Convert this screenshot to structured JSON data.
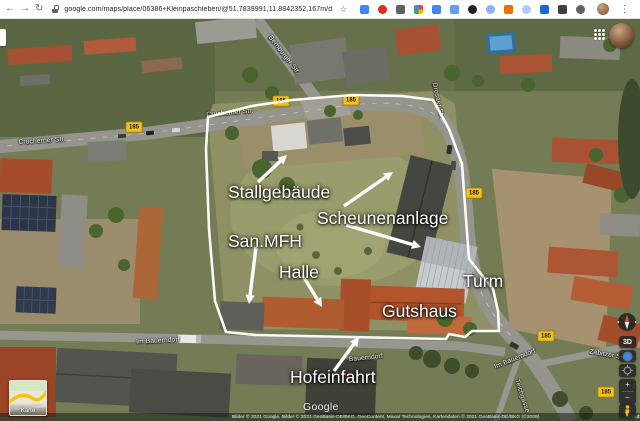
{
  "browser": {
    "back": "←",
    "forward": "→",
    "reload": "↻",
    "url": "google.com/maps/place/06386+Kleinpaschleben/@51.7839991,11.8842352,167m/data=!3m1!1e3!4m5!3m4!1s0x47a60a9324ba2fc1:0...",
    "bookmark_star": "☆",
    "menu": "⋮",
    "extensions": [
      {
        "color": "#4285f4"
      },
      {
        "color": "#d93025",
        "shape": "round"
      },
      {
        "color": "#5f6368"
      },
      {
        "color": "multi"
      },
      {
        "color": "#4285f4"
      },
      {
        "color": "#669df6"
      },
      {
        "color": "#202124",
        "shape": "round"
      },
      {
        "color": "#8ab4f8",
        "shape": "round"
      },
      {
        "color": "#e8710a"
      },
      {
        "color": "#aecbfa",
        "shape": "round"
      },
      {
        "color": "#1967d2"
      },
      {
        "color": "#3c4043"
      },
      {
        "color": "#5f6368",
        "shape": "round"
      }
    ]
  },
  "map": {
    "property_labels": [
      {
        "text": "Stallgebäude",
        "x": 228,
        "y": 163,
        "size": 17.5
      },
      {
        "text": "Scheunenanlage",
        "x": 317,
        "y": 189,
        "size": 17.5
      },
      {
        "text": "San.MFH",
        "x": 228,
        "y": 212,
        "size": 17.5
      },
      {
        "text": "Halle",
        "x": 279,
        "y": 243,
        "size": 17.5
      },
      {
        "text": "Turm",
        "x": 463,
        "y": 252,
        "size": 17.5
      },
      {
        "text": "Gutshaus",
        "x": 382,
        "y": 282,
        "size": 17.5
      },
      {
        "text": "Hofeinfahrt",
        "x": 290,
        "y": 348,
        "size": 17.5
      }
    ],
    "arrows": [
      {
        "x1": 258,
        "y1": 163,
        "x2": 287,
        "y2": 136
      },
      {
        "x1": 344,
        "y1": 187,
        "x2": 393,
        "y2": 153
      },
      {
        "x1": 346,
        "y1": 206,
        "x2": 421,
        "y2": 228
      },
      {
        "x1": 256,
        "y1": 228,
        "x2": 249,
        "y2": 285
      },
      {
        "x1": 303,
        "y1": 257,
        "x2": 322,
        "y2": 288
      },
      {
        "x1": 334,
        "y1": 352,
        "x2": 359,
        "y2": 318
      }
    ],
    "street_labels": [
      {
        "text": "Bernburger Str.",
        "x": 284,
        "y": 36,
        "rot": 52
      },
      {
        "text": "Crucherner Str.",
        "x": 42,
        "y": 122,
        "rot": -4
      },
      {
        "text": "Crucherner Str.",
        "x": 230,
        "y": 94,
        "rot": -5
      },
      {
        "text": "Drosaer Str.",
        "x": 438,
        "y": 82,
        "rot": 78
      },
      {
        "text": "Im Bauerndorf",
        "x": 158,
        "y": 322,
        "rot": -3
      },
      {
        "text": "Bauerndorf",
        "x": 366,
        "y": 339,
        "rot": -6
      },
      {
        "text": "Im Bauerndorf",
        "x": 515,
        "y": 340,
        "rot": -22
      },
      {
        "text": "Teichgasse",
        "x": 522,
        "y": 377,
        "rot": 72
      },
      {
        "text": "Zabitzer Str.",
        "x": 608,
        "y": 336,
        "rot": 10
      }
    ],
    "route_badge": {
      "label": "185",
      "positions": [
        {
          "x": 134,
          "y": 108
        },
        {
          "x": 281,
          "y": 82
        },
        {
          "x": 351,
          "y": 81
        },
        {
          "x": 474,
          "y": 174
        },
        {
          "x": 546,
          "y": 317
        },
        {
          "x": 606,
          "y": 373
        }
      ]
    },
    "controls": {
      "three_d": "3D",
      "zoom_in": "+",
      "zoom_out": "−"
    },
    "inset_label": "Karte",
    "watermark": "Google",
    "attribution": {
      "credits": "Bilder © 2021 Google, Bilder © 2021 GeoBasis-DE/BKG, GeoContent, Maxar Technologies, Kartendaten © 2021 GeoBasis-DE/BKG (©2009)",
      "links": [
        "Deutschland",
        "Nutzungsbedingungen",
        "Feedback geben"
      ],
      "scale": "20 m"
    }
  },
  "colors": {
    "route_badge_bg": "#f2c21a",
    "annotation_text": "#ffffff",
    "property_boundary": "#ffffff",
    "control_bg": "#202124",
    "location_blue": "#4285f4",
    "pegman_yellow": "#fbbc04"
  }
}
